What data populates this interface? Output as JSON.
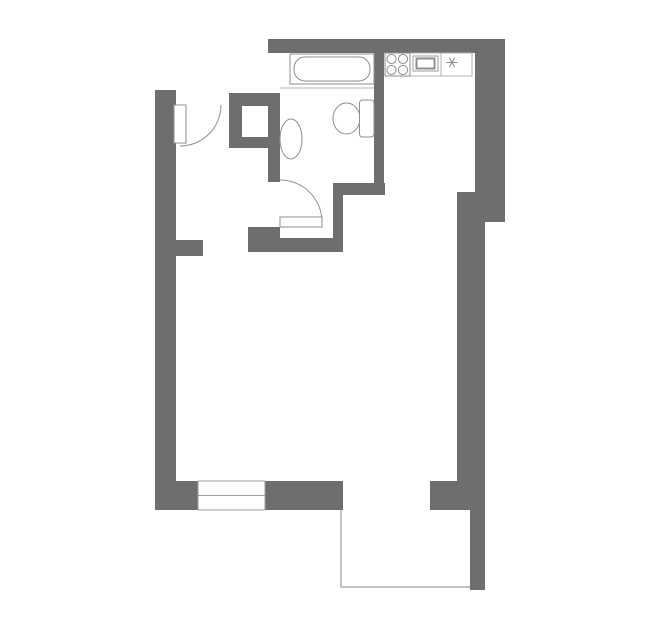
{
  "canvas": {
    "width": 659,
    "height": 635,
    "background": "#ffffff"
  },
  "colors": {
    "wall": "#6e6e6e",
    "fixture": "#8f8f8f",
    "light": "#b3b3b3",
    "opening": "#9e9e9e",
    "balcony": "#b0b0b0",
    "white": "#ffffff",
    "none": "none"
  },
  "plan": {
    "walls": [
      {
        "name": "wall-top",
        "x": 268,
        "y": 39,
        "w": 237,
        "h": 14
      },
      {
        "name": "wall-right-upper",
        "x": 475,
        "y": 53,
        "w": 30,
        "h": 139
      },
      {
        "name": "wall-right-step",
        "x": 457,
        "y": 192,
        "w": 48,
        "h": 30
      },
      {
        "name": "wall-right-main",
        "x": 457,
        "y": 222,
        "w": 28,
        "h": 261
      },
      {
        "name": "wall-bottom-right",
        "x": 430,
        "y": 481,
        "w": 55,
        "h": 29
      },
      {
        "name": "wall-balcony-right",
        "x": 470,
        "y": 510,
        "w": 15,
        "h": 80
      },
      {
        "name": "wall-bottom-left",
        "x": 155,
        "y": 481,
        "w": 188,
        "h": 29
      },
      {
        "name": "wall-left",
        "x": 155,
        "y": 90,
        "w": 21,
        "h": 393
      },
      {
        "name": "wall-left-stub",
        "x": 176,
        "y": 240,
        "w": 27,
        "h": 16
      },
      {
        "name": "wall-hall-top-segment",
        "x": 229,
        "y": 93,
        "w": 51,
        "h": 13
      },
      {
        "name": "wall-shaft-left",
        "x": 229,
        "y": 106,
        "w": 13,
        "h": 42
      },
      {
        "name": "wall-shaft-bottom",
        "x": 229,
        "y": 137,
        "w": 39,
        "h": 11
      },
      {
        "name": "wall-bathroom-left",
        "x": 268,
        "y": 93,
        "w": 12,
        "h": 89
      },
      {
        "name": "wall-bath-door-stub",
        "x": 248,
        "y": 227,
        "w": 32,
        "h": 11
      },
      {
        "name": "wall-bath-bottom",
        "x": 248,
        "y": 238,
        "w": 95,
        "h": 14
      },
      {
        "name": "wall-bath-kitchen-horiz",
        "x": 333,
        "y": 183,
        "w": 52,
        "h": 12
      },
      {
        "name": "wall-bath-kitchen-vert",
        "x": 333,
        "y": 195,
        "w": 10,
        "h": 45
      },
      {
        "name": "wall-bath-kitchen-divider",
        "x": 374,
        "y": 53,
        "w": 10,
        "h": 142
      }
    ],
    "shapes": [
      {
        "name": "window",
        "el": "rect",
        "x": 198,
        "y": 481,
        "w": 67,
        "h": 29,
        "fill": "white",
        "stroke": "opening",
        "sw": 1
      },
      {
        "name": "window-center-line",
        "el": "line",
        "x1": 198,
        "y1": 495.5,
        "x2": 265,
        "y2": 495.5,
        "stroke": "opening",
        "sw": 1
      },
      {
        "name": "balcony-outline",
        "el": "polyline",
        "points": "341,510 341,587 470,587",
        "fill": "none",
        "stroke": "balcony",
        "sw": 1.5
      },
      {
        "name": "entry-door-arc",
        "el": "path",
        "d": "M 180 146 A 41 41 0 0 0 221 105",
        "fill": "none",
        "stroke": "fixture",
        "sw": 1
      },
      {
        "name": "entry-door-leaf",
        "el": "rect",
        "x": 174,
        "y": 105,
        "w": 12,
        "h": 38,
        "fill": "white",
        "stroke": "fixture",
        "sw": 1
      },
      {
        "name": "bathroom-door-arc",
        "el": "path",
        "d": "M 280 180 A 42 42 0 0 1 322 222",
        "fill": "none",
        "stroke": "fixture",
        "sw": 1
      },
      {
        "name": "bathroom-door-leaf",
        "el": "rect",
        "x": 280,
        "y": 217,
        "w": 42,
        "h": 10,
        "fill": "white",
        "stroke": "fixture",
        "sw": 1
      },
      {
        "name": "bathtub-platform-line",
        "el": "line",
        "x1": 280,
        "y1": 88,
        "x2": 374,
        "y2": 88,
        "stroke": "light",
        "sw": 1
      },
      {
        "name": "bathtub-outer",
        "el": "rect",
        "x": 290,
        "y": 54,
        "w": 84,
        "h": 30,
        "fill": "white",
        "stroke": "fixture",
        "sw": 1
      },
      {
        "name": "bathtub-inner",
        "el": "rect",
        "x": 294,
        "y": 57,
        "w": 76,
        "h": 24,
        "rx": 11,
        "fill": "white",
        "stroke": "fixture",
        "sw": 1
      },
      {
        "name": "toilet-bowl",
        "el": "ellipse",
        "cx": 346.5,
        "cy": 118.5,
        "rx": 13.5,
        "ry": 15.5,
        "fill": "white",
        "stroke": "fixture",
        "sw": 1
      },
      {
        "name": "toilet-tank",
        "el": "rect",
        "x": 359.5,
        "y": 100,
        "w": 14.5,
        "h": 37,
        "rx": 3,
        "fill": "white",
        "stroke": "fixture",
        "sw": 1
      },
      {
        "name": "sink",
        "el": "ellipse",
        "cx": 291,
        "cy": 139,
        "rx": 11,
        "ry": 20,
        "fill": "white",
        "stroke": "fixture",
        "sw": 1
      },
      {
        "name": "kitchen-counter",
        "el": "rect",
        "x": 385,
        "y": 53,
        "w": 87,
        "h": 23,
        "fill": "white",
        "stroke": "light",
        "sw": 1
      },
      {
        "name": "counter-divider-1",
        "el": "line",
        "x1": 410,
        "y1": 53,
        "x2": 410,
        "y2": 76,
        "stroke": "light",
        "sw": 1
      },
      {
        "name": "counter-divider-2",
        "el": "line",
        "x1": 441,
        "y1": 53,
        "x2": 441,
        "y2": 76,
        "stroke": "light",
        "sw": 1
      },
      {
        "name": "stove",
        "el": "rect",
        "x": 385,
        "y": 53,
        "w": 25,
        "h": 23,
        "fill": "white",
        "stroke": "fixture",
        "sw": 1
      },
      {
        "name": "stove-burner-1",
        "el": "circle",
        "cx": 391.5,
        "cy": 59,
        "r": 4.6,
        "fill": "white",
        "stroke": "fixture",
        "sw": 1
      },
      {
        "name": "stove-burner-2",
        "el": "circle",
        "cx": 403,
        "cy": 59,
        "r": 4.6,
        "fill": "white",
        "stroke": "fixture",
        "sw": 1
      },
      {
        "name": "stove-burner-3",
        "el": "circle",
        "cx": 391.5,
        "cy": 70,
        "r": 4.6,
        "fill": "white",
        "stroke": "fixture",
        "sw": 1
      },
      {
        "name": "stove-burner-4",
        "el": "circle",
        "cx": 403,
        "cy": 70,
        "r": 4.6,
        "fill": "white",
        "stroke": "fixture",
        "sw": 1
      },
      {
        "name": "oven-outer",
        "el": "rect",
        "x": 413,
        "y": 56,
        "w": 25,
        "h": 15,
        "fill": "white",
        "stroke": "opening",
        "sw": 1
      },
      {
        "name": "oven-inner",
        "el": "rect",
        "x": 416.5,
        "y": 58.5,
        "w": 18,
        "h": 10,
        "fill": "white",
        "stroke": "fixture",
        "sw": 2
      },
      {
        "name": "fridge-snowflake-icon",
        "el": "line",
        "x1": 446.5,
        "y1": 62.5,
        "x2": 457.5,
        "y2": 62.5,
        "stroke": "fixture",
        "sw": 1
      },
      {
        "name": "fridge-snowflake-icon",
        "el": "line",
        "x1": 449.3,
        "y1": 57.7,
        "x2": 454.7,
        "y2": 67.3,
        "stroke": "fixture",
        "sw": 1
      },
      {
        "name": "fridge-snowflake-icon",
        "el": "line",
        "x1": 454.7,
        "y1": 57.7,
        "x2": 449.3,
        "y2": 67.3,
        "stroke": "fixture",
        "sw": 1
      }
    ]
  }
}
